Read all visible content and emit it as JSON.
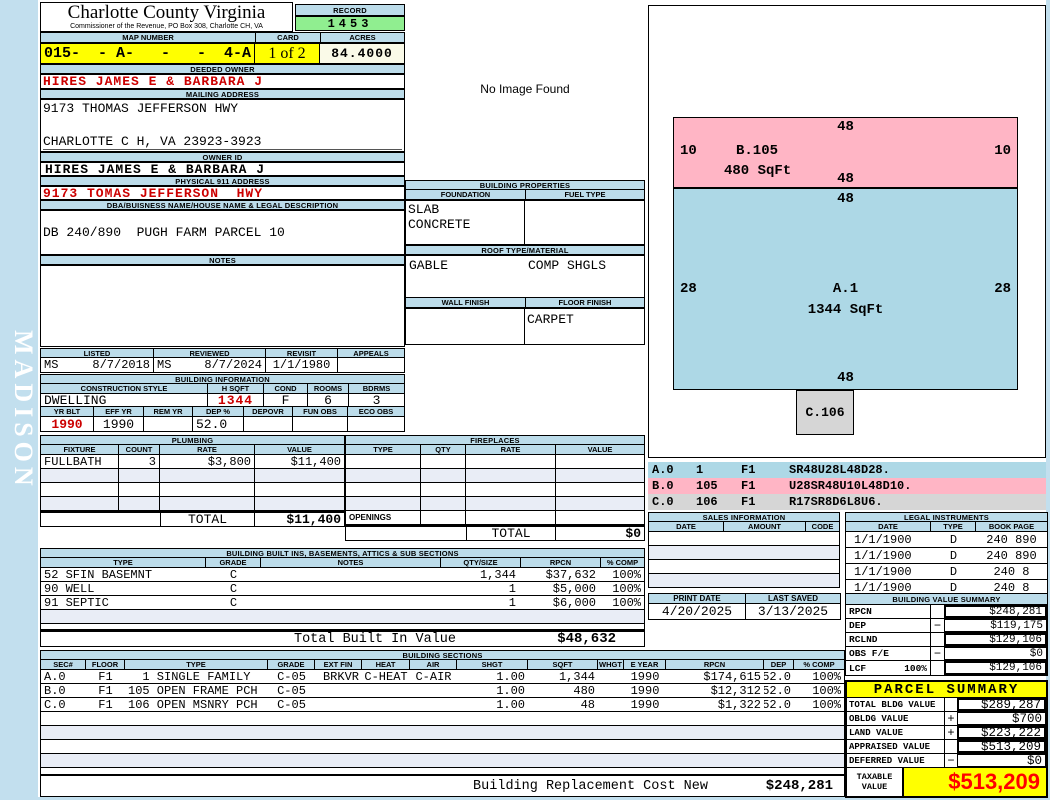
{
  "page": {
    "watermark": "MADISON",
    "no_image": "No Image Found"
  },
  "header": {
    "county": "Charlotte County Virginia",
    "commissioner": "Commissioner of the Revenue, PO Box 308, Charlotte CH, VA",
    "record_label": "RECORD",
    "record": "1453",
    "map_label": "MAP NUMBER",
    "map_number": "015-  - A-   -   -  4-A",
    "card_label": "CARD",
    "card": "1 of 2",
    "acres_label": "ACRES",
    "acres": "84.4000"
  },
  "owner": {
    "deeded_label": "DEEDED OWNER",
    "deeded": "HIRES JAMES E & BARBARA J",
    "mailing_label": "MAILING ADDRESS",
    "mail1": "9173 THOMAS JEFFERSON HWY",
    "mail2": "CHARLOTTE C H, VA 23923-3923",
    "ownerid_label": "OWNER ID",
    "ownerid": "HIRES JAMES E & BARBARA J",
    "physical_label": "PHYSICAL 911 ADDRESS",
    "physical": "9173 TOMAS JEFFERSON  HWY",
    "dba_label": "DBA/BUISNESS NAME/HOUSE NAME & LEGAL DESCRIPTION",
    "legal_description": "DB 240/890  PUGH FARM PARCEL 10",
    "notes_label": "NOTES"
  },
  "visits": {
    "listed_label": "LISTED",
    "listed_by": "MS",
    "listed_date": "8/7/2018",
    "reviewed_label": "REVIEWED",
    "reviewed_by": "MS",
    "reviewed_date": "8/7/2024",
    "revisit_label": "REVISIT",
    "revisit": "1/1/1980",
    "appeals_label": "APPEALS"
  },
  "building_info": {
    "title": "BUILDING INFORMATION",
    "style_label": "CONSTRUCTION STYLE",
    "style": "DWELLING",
    "hsqft_label": "H SQFT",
    "hsqft": "1344",
    "cond_label": "COND",
    "cond": "F",
    "rooms_label": "ROOMS",
    "rooms": "6",
    "bdrms_label": "BDRMS",
    "bdrms": "3",
    "yrblt_label": "YR BLT",
    "yrblt": "1990",
    "effyr_label": "EFF YR",
    "effyr": "1990",
    "remyr_label": "REM YR",
    "dep_label": "DEP %",
    "dep": "52.0",
    "depovr_label": "DEPOVR",
    "funobs_label": "FUN OBS",
    "ecoobs_label": "ECO OBS"
  },
  "properties": {
    "title": "BUILDING PROPERTIES",
    "foundation_label": "FOUNDATION",
    "foundation1": "SLAB",
    "foundation2": "CONCRETE",
    "fuel_label": "FUEL TYPE",
    "roof_label": "ROOF TYPE/MATERIAL",
    "roof_type": "GABLE",
    "roof_material": "COMP SHGLS",
    "wall_label": "WALL FINISH",
    "floor_label": "FLOOR FINISH",
    "floor_finish": "CARPET"
  },
  "plumbing": {
    "title": "PLUMBING",
    "headers": [
      "FIXTURE",
      "COUNT",
      "RATE",
      "VALUE"
    ],
    "rows": [
      [
        "FULLBATH",
        "3",
        "$3,800",
        "$11,400"
      ]
    ],
    "total_label": "TOTAL",
    "total": "$11,400"
  },
  "fireplaces": {
    "title": "FIREPLACES",
    "headers": [
      "TYPE",
      "QTY",
      "RATE",
      "VALUE"
    ],
    "openings_label": "OPENINGS",
    "total_label": "TOTAL",
    "total": "$0"
  },
  "built_ins": {
    "title": "BUILDING BUILT INS, BASEMENTS, ATTICS & SUB SECTIONS",
    "headers": [
      "TYPE",
      "GRADE",
      "NOTES",
      "QTY/SIZE",
      "RPCN",
      "% COMP"
    ],
    "rows": [
      [
        "52 SFIN BASEMNT",
        "C",
        "",
        "1,344",
        "$37,632",
        "100%"
      ],
      [
        "90 WELL",
        "C",
        "",
        "1",
        "$5,000",
        "100%"
      ],
      [
        "91 SEPTIC",
        "C",
        "",
        "1",
        "$6,000",
        "100%"
      ]
    ],
    "total_label": "Total Built In Value",
    "total": "$48,632"
  },
  "sections": {
    "title": "BUILDING SECTIONS",
    "headers": [
      "SEC#",
      "FLOOR",
      "TYPE",
      "GRADE",
      "EXT FIN",
      "HEAT",
      "AIR",
      "SHGT",
      "SQFT",
      "WHGT",
      "E YEAR",
      "RPCN",
      "DEP",
      "% COMP"
    ],
    "rows": [
      [
        "A.0",
        "F1",
        "  1 SINGLE FAMILY",
        "C-05",
        "BRKVR",
        "C-HEAT",
        "C-AIR",
        "1.00",
        "1,344",
        "",
        "1990",
        "$174,615",
        "52.0",
        "100%"
      ],
      [
        "B.0",
        "F1",
        "105 OPEN FRAME PCH",
        "C-05",
        "",
        "",
        "",
        "1.00",
        "480",
        "",
        "1990",
        "$12,312",
        "52.0",
        "100%"
      ],
      [
        "C.0",
        "F1",
        "106 OPEN MSNRY PCH",
        "C-05",
        "",
        "",
        "",
        "1.00",
        "48",
        "",
        "1990",
        "$1,322",
        "52.0",
        "100%"
      ]
    ],
    "footer_label": "Building Replacement Cost New",
    "footer_value": "$248,281"
  },
  "sketch": {
    "b": {
      "name": "B.105",
      "sqft": "480 SqFt",
      "top": "48",
      "left": "10",
      "right": "10",
      "bottom": "48"
    },
    "a": {
      "name": "A.1",
      "sqft": "1344 SqFt",
      "top": "48",
      "left": "28",
      "right": "28",
      "bottom": "48"
    },
    "c": {
      "name": "C.106"
    },
    "legend": [
      [
        "A.0",
        "1",
        "F1",
        "SR48U28L48D28."
      ],
      [
        "B.0",
        "105",
        "F1",
        "U28SR48U10L48D10."
      ],
      [
        "C.0",
        "106",
        "F1",
        "R17SR8D6L8U6."
      ]
    ]
  },
  "sales": {
    "title": "SALES INFORMATION",
    "headers": [
      "DATE",
      "AMOUNT",
      "CODE"
    ]
  },
  "legal": {
    "title": "LEGAL INSTRUMENTS",
    "headers": [
      "DATE",
      "TYPE",
      "BOOK PAGE"
    ],
    "rows": [
      [
        "1/1/1900",
        "D",
        "240 890"
      ],
      [
        "1/1/1900",
        "D",
        "240 890"
      ],
      [
        "1/1/1900",
        "D",
        "240 8"
      ],
      [
        "1/1/1900",
        "D",
        "240 8"
      ]
    ]
  },
  "print_info": {
    "print_label": "PRINT DATE",
    "print_date": "4/20/2025",
    "saved_label": "LAST SAVED",
    "saved_date": "3/13/2025"
  },
  "value_summary": {
    "title": "BUILDING VALUE SUMMARY",
    "rows": [
      [
        "RPCN",
        "",
        "",
        "$248,281"
      ],
      [
        "DEP",
        "",
        "−",
        "$119,175"
      ],
      [
        "RCLND",
        "",
        "",
        "$129,106"
      ],
      [
        "OBS F/E",
        "",
        "−",
        "$0"
      ],
      [
        "LCF",
        "100%",
        "",
        "$129,106"
      ]
    ]
  },
  "parcel": {
    "title": "PARCEL SUMMARY",
    "rows": [
      [
        "TOTAL BLDG VALUE",
        "",
        "$289,287"
      ],
      [
        "OBLDG VALUE",
        "+",
        "$700"
      ],
      [
        "LAND VALUE",
        "+",
        "$223,222"
      ],
      [
        "APPRAISED VALUE",
        "",
        "$513,209"
      ],
      [
        "DEFERRED VALUE",
        "−",
        "$0"
      ]
    ],
    "taxable_label": "TAXABLE VALUE",
    "taxable": "$513,209"
  },
  "colors": {
    "header_bar": "#bcdcea",
    "record_green": "#90ee90",
    "highlight_yellow": "#ffff00",
    "sketch_pink": "#ffb5c5",
    "sketch_blue": "#add8e6",
    "sketch_gray": "#d6d6d6",
    "value_red": "#cc0000",
    "taxable_red": "#ff0000"
  }
}
